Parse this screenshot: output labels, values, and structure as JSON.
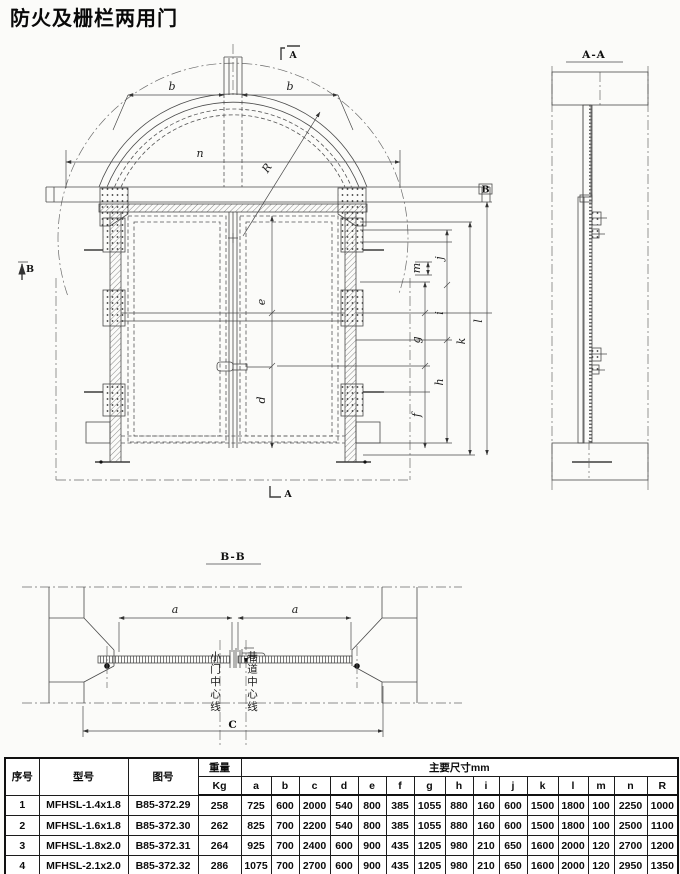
{
  "title": "防火及栅栏两用门",
  "front": {
    "marker_top": "A",
    "marker_bottom": "A",
    "marker_left": "B",
    "marker_right": "B",
    "dims": {
      "b1": "b",
      "b2": "b",
      "n": "n",
      "R": "R",
      "e": "e",
      "d": "d",
      "m": "m",
      "j": "j",
      "i": "i",
      "g": "g",
      "h": "h",
      "f": "f",
      "k": "k",
      "l": "l"
    }
  },
  "side": {
    "label": "A-A"
  },
  "plan": {
    "label": "B-B",
    "dims": {
      "a1": "a",
      "a2": "a",
      "C": "C"
    },
    "door_centerline": "小门中心线",
    "tunnel_centerline": "巷道中心线"
  },
  "table": {
    "col_index": "序号",
    "col_model": "型号",
    "col_drawno": "图号",
    "col_weight": "重量",
    "col_weight_unit": "Kg",
    "col_dims_group": "主要尺寸mm",
    "dim_cols": [
      "a",
      "b",
      "c",
      "d",
      "e",
      "f",
      "g",
      "h",
      "i",
      "j",
      "k",
      "l",
      "m",
      "n",
      "R"
    ],
    "rows": [
      {
        "no": "1",
        "model": "MFHSL-1.4x1.8",
        "drawno": "B85-372.29",
        "weight": "258",
        "vals": [
          "725",
          "600",
          "2000",
          "540",
          "800",
          "385",
          "1055",
          "880",
          "160",
          "600",
          "1500",
          "1800",
          "100",
          "2250",
          "1000"
        ]
      },
      {
        "no": "2",
        "model": "MFHSL-1.6x1.8",
        "drawno": "B85-372.30",
        "weight": "262",
        "vals": [
          "825",
          "700",
          "2200",
          "540",
          "800",
          "385",
          "1055",
          "880",
          "160",
          "600",
          "1500",
          "1800",
          "100",
          "2500",
          "1100"
        ]
      },
      {
        "no": "3",
        "model": "MFHSL-1.8x2.0",
        "drawno": "B85-372.31",
        "weight": "264",
        "vals": [
          "925",
          "700",
          "2400",
          "600",
          "900",
          "435",
          "1205",
          "980",
          "210",
          "650",
          "1600",
          "2000",
          "120",
          "2700",
          "1200"
        ]
      },
      {
        "no": "4",
        "model": "MFHSL-2.1x2.0",
        "drawno": "B85-372.32",
        "weight": "286",
        "vals": [
          "1075",
          "700",
          "2700",
          "600",
          "900",
          "435",
          "1205",
          "980",
          "210",
          "650",
          "1600",
          "2000",
          "120",
          "2950",
          "1350"
        ]
      }
    ]
  }
}
